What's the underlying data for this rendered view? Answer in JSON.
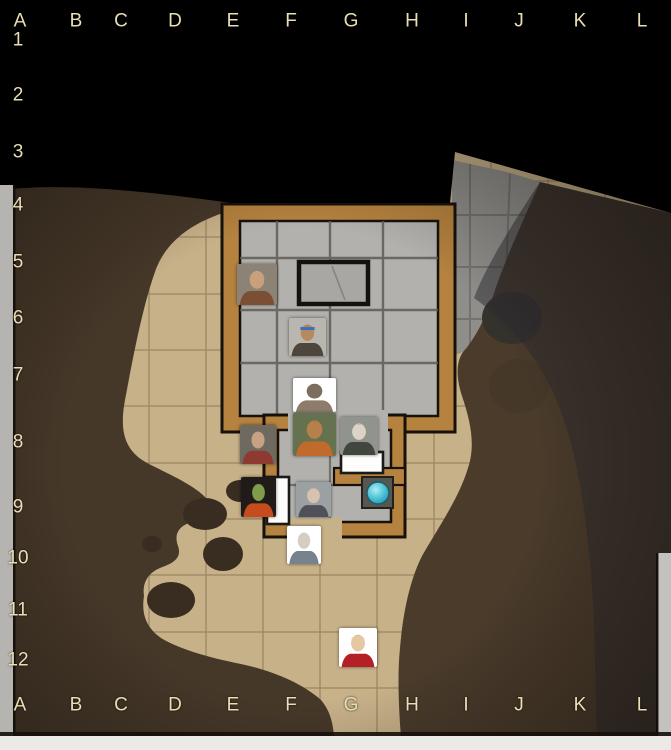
{
  "scene": {
    "name": "dungeon-battle-map",
    "kind": "virtual-tabletop battle map with fog of war"
  },
  "grid": {
    "columns": [
      "A",
      "B",
      "C",
      "D",
      "E",
      "F",
      "G",
      "H",
      "I",
      "J",
      "K",
      "L"
    ],
    "rows": [
      "1",
      "2",
      "3",
      "4",
      "5",
      "6",
      "7",
      "8",
      "9",
      "10",
      "11",
      "12"
    ],
    "label_color": "#e9deb4"
  },
  "map": {
    "colors": {
      "fog_of_war": "#000000",
      "cave_floor": "#c7b189",
      "cave_floor_gridline": "#93805d",
      "rock_brown": "#463829",
      "rock_boulder": "#392d21",
      "stone_floor": "#b2b1ad",
      "stone_tile_line": "#5f5c55",
      "dim_stone_floor": "#8f8e8b",
      "dim_rock_gray": "#35322e",
      "wood_wall": "#b5823f",
      "wall_outline": "#17110a",
      "door_white": "#fdfdfb",
      "orb_teal": "#38b9cf",
      "paper_edge": "#b5b4b1"
    },
    "features": {
      "hall": "stone hall with wooden walls",
      "vestibule": "small stone antechamber with two doors",
      "table": "dark-bordered stone table",
      "door_horizontal": "closed white door (east threshold)",
      "door_vertical": "closed white door (west threshold)",
      "orb": "glowing teal orb on dark basin tile",
      "fog": "unexplored black fog of war (rows 1-3)",
      "dim_zone": "explored but unlit grayscale area (northeast)",
      "cave": "brown cavern walls and boulders with sand floor passages"
    }
  },
  "tokens": [
    {
      "name": "white-haired-barbarian",
      "cell": "E5",
      "x": 237,
      "y": 264,
      "w": 40,
      "h": 41,
      "colors": {
        "bg": "#8d8276",
        "skin": "#c9a07b",
        "hair": "#eee9dd",
        "cloth": "#7b4f33"
      }
    },
    {
      "name": "blue-bandana-monk",
      "cell": "F6",
      "x": 289,
      "y": 318,
      "w": 37,
      "h": 38,
      "colors": {
        "bg": "#b9b6af",
        "skin": "#b48a5e",
        "hair": "#332e29",
        "cloth": "#4d463d",
        "band": "#3f6cc0"
      }
    },
    {
      "name": "rust-creature",
      "cell": "F7",
      "x": 293,
      "y": 378,
      "w": 43,
      "h": 34,
      "colors": {
        "bg": "#ffffff",
        "skin": "#7c6e5f",
        "hair": "#564c41",
        "cloth": "#8d7c6a"
      }
    },
    {
      "name": "shaggy-bearded-ranger",
      "cell": "F8",
      "x": 293,
      "y": 413,
      "w": 43,
      "h": 43,
      "colors": {
        "bg": "#66724f",
        "skin": "#b5804c",
        "hair": "#5f4023",
        "cloth": "#c06a2b"
      }
    },
    {
      "name": "gray-haired-noble",
      "cell": "E8",
      "x": 240,
      "y": 425,
      "w": 36,
      "h": 39,
      "colors": {
        "bg": "#6f6a60",
        "skin": "#c6a183",
        "hair": "#bcb6ac",
        "cloth": "#8e3a30"
      }
    },
    {
      "name": "pale-dark-haired-woman",
      "cell": "G8",
      "x": 340,
      "y": 417,
      "w": 38,
      "h": 38,
      "colors": {
        "bg": "#90948c",
        "skin": "#ddd2c6",
        "hair": "#211f21",
        "cloth": "#41473e"
      }
    },
    {
      "name": "green-skinned-sorcerer",
      "cell": "E9",
      "x": 241,
      "y": 477,
      "w": 35,
      "h": 40,
      "colors": {
        "bg": "#201b18",
        "skin": "#7f9c4d",
        "hair": "#1c1916",
        "cloth": "#c64c1d"
      }
    },
    {
      "name": "purple-haired-archer",
      "cell": "F9",
      "x": 296,
      "y": 482,
      "w": 35,
      "h": 35,
      "colors": {
        "bg": "#9ba1a3",
        "skin": "#d8c2ad",
        "hair": "#7c4e6d",
        "cloth": "#50505a"
      }
    },
    {
      "name": "winged-helm-warrior",
      "cell": "F10",
      "x": 287,
      "y": 526,
      "w": 34,
      "h": 38,
      "colors": {
        "bg": "#ffffff",
        "skin": "#d6cdc2",
        "hair": "#d8d8d4",
        "cloth": "#78828e"
      }
    },
    {
      "name": "red-haired-duelist",
      "cell": "G12",
      "x": 339,
      "y": 628,
      "w": 38,
      "h": 39,
      "colors": {
        "bg": "#ffffff",
        "skin": "#e7c6a4",
        "hair": "#d9571c",
        "cloth": "#b32025"
      }
    }
  ]
}
